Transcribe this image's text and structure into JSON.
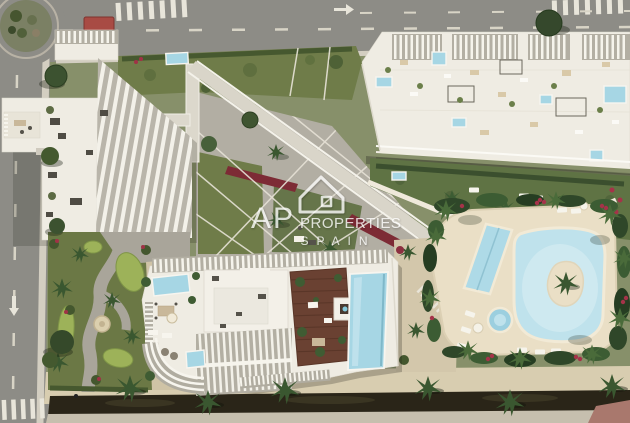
{
  "watermark": {
    "icon": "house-outline-icon",
    "brand_left": "AP",
    "brand_right": "PROPERTIES",
    "brand_sub": "SPAIN"
  },
  "palette": {
    "road_grey": "#8d8c86",
    "ground_green": "#87906a",
    "lawn_green": "#6f7c49",
    "foliage_dark": "#31492b",
    "building_white": "#efece3",
    "plaza_grey": "#b2aea3",
    "pool_blue": "#a6d6e4",
    "lagoon_blue": "#c8e6ef",
    "sand_deck": "#eadfc6",
    "wood_deck": "#6a4132",
    "flower_red": "#7d2b35",
    "flower_pink": "#a53349",
    "canal_dark": "#2a2518",
    "watermark_white": "#ffffff"
  }
}
